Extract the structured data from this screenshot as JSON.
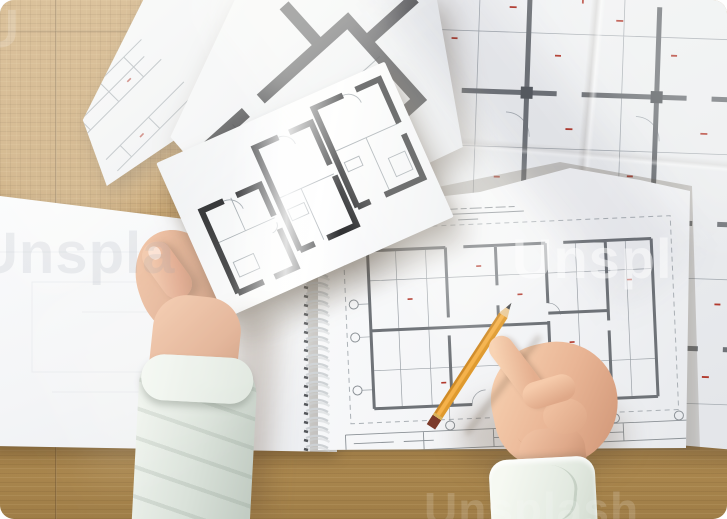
{
  "scene": {
    "description": "Overhead photo of an architect's wooden desk: several floor-plan drawings, a spiral-bound pad with a pencil-drawn apartment plan, a left hand holding a small plan sheet and a right hand writing with a yellow pencil."
  },
  "watermarks": {
    "center": "Unspl",
    "left_partial": "Unspla",
    "bottom": "Unsplash",
    "top_left_partial": "U"
  },
  "palette": {
    "wood_base": "#bf9963",
    "wood_light": "#d7b77f",
    "wood_seam": "#7d5f35",
    "paper_white": "#f7f8f9",
    "plan_wall_dark": "#2b2c2e",
    "plan_wall_gray": "#6e7277",
    "plan_line_gray": "#9aa2a8",
    "plan_line_faint": "#b9bfc5",
    "red_annotation": "#b23a2e",
    "column_fill": "#565a5f",
    "skin": "#e0a98c",
    "sleeve_left": "#dde4dd",
    "sleeve_right": "#eef2ed",
    "pencil_yellow": "#eda63a",
    "pencil_ferrule": "#7c3a2a",
    "graphite": "#434548",
    "spiral_wire": "#cdd1d4",
    "spiral_dark": "#53565a"
  },
  "drawings": {
    "held_walls": "M22 152 V62 H46 M60 62 H86 V96 M86 110 V152 H62 M50 152 H22 M96 138 V26 H122 M134 26 H158 V72 M158 84 V138 H126 M112 138 H96 M166 122 V14 H198 M212 14 H238 V62 M238 74 V122 H196 M180 122 H166",
    "held_thin": "M22 98 H86 M54 62 V98 M96 82 H158 M122 82 V138 M166 62 H238 M202 62 V122 M30 122 h22 v16 h-22 z M101 96 h18 v12 h-18 z M172 76 h16 v10 h-16 z M214 90 h18 v20 h-18 z",
    "held_doors": "M46 62 a15 15 0 0 1 15 15 M122 26 a13 13 0 0 1 13 13 M198 14 a14 14 0 0 1 14 14 M86 103 a8 8 0 0 1 -8 8",
    "dark_walls": "M10 72 H118 M138 72 H255 V128 M58 72 V178 M58 198 V250 M58 178 H168 M188 178 H255 V128 M218 72 V18 M255 100 H320",
    "dark_thin": "M100 72 V178 M58 120 H255 M150 120 V178",
    "dark_detail": "M70 90 h26 v14 h-26 z M200 140 h30 v16 h-30 z",
    "sketch_lines": "M10 20 H120 M10 34 H110 M10 48 H120 M20 20 V48 M60 20 V48 M95 20 V48 M10 80 H120 M10 96 H115 M30 80 V96 M70 80 V96 M10 120 H100 M10 134 H96 M40 120 V134",
    "sketch_red": "M30 28 h5 M80 40 h5 M50 88 h5 M85 126 h5",
    "detail_walls": "M5 130 H75 M100 130 H195 M220 130 H325 M350 130 H405 M55 130 V45 M165 130 V35 M295 130 V40 M385 130 V45 M5 255 H85 M110 255 H205 M230 255 H335 M360 255 H405 M55 255 V130 M165 255 V130 M295 255 V130 M385 255 V130 M5 380 H95 M120 380 H215 M240 380 H345 M370 380 H405 M75 380 V255 M185 380 V255 M315 380 V255 M395 380 V255",
    "detail_cols": "M49 124 h12 v12 h-12 z M159 124 h12 v12 h-12 z M289 124 h12 v12 h-12 z M379 124 h12 v12 h-12 z M49 249 h12 v12 h-12 z M159 249 h12 v12 h-12 z M289 249 h12 v12 h-12 z M379 249 h12 v12 h-12 z M69 374 h12 v12 h-12 z M179 374 h12 v12 h-12 z M309 374 h12 v12 h-12 z",
    "detail_thin": "M5 70 H405 M5 185 H405 M5 310 H405 M5 435 H405 M115 5 V465 M260 5 V465 M35 150 a24 24 0 0 1 24 24 M145 150 a24 24 0 0 1 24 24 M275 150 a24 24 0 0 1 24 24 M35 275 a24 24 0 0 1 24 24 M145 275 a24 24 0 0 1 24 24 M275 275 a24 24 0 0 1 24 24 M55 400 a24 24 0 0 1 24 24 M185 400 a24 24 0 0 1 24 24",
    "detail_red": "M30 50 h7 M88 78 h6 M145 45 h7 M192 92 h6 M252 55 h7 M308 88 h6 M365 50 h7 M22 155 h6 M78 182 h7 M135 215 h6 M205 165 h7 M268 210 h6 M340 165 h7 M390 205 h6 M38 285 h7 M98 330 h6 M160 295 h7 M232 340 h6 M298 290 h7 M360 335 h6 M48 408 h7 M125 430 h6 M208 408 h7 M288 435 h6 M350 408 h7 M392 365 h6 M62 22 v7 M218 32 v7 M332 18 v7 M378 275 v7 M258 385 v7 M92 248 v7",
    "ghost_lines": "M0 60 H180 M40 90 H200 V180 H40 Z M90 120 H170 M60 200 H240 V250",
    "nb_frame": "M28 58 H356 V252 H28 Z",
    "nb_walls": "M52 80 H130 M148 80 H230 M248 80 H336 M52 80 V238 M336 80 V238 M52 238 H150 M170 238 H336 M130 80 V150 M130 168 V238 M230 80 V140 M230 158 V238 M290 80 V160 M52 160 H130 M230 150 H290 M290 170 V238 M180 80 V120 M180 140 V160 M130 160 H230",
    "nb_thin": "M80 80 V238 M110 80 V238 M260 80 V238 M310 80 V238 M52 110 H336 M52 200 H336 M150 238 a14 14 0 0 1 14 -14 M230 140 a12 12 0 0 1 12 12 M40.5 133 H52 M40.5 166 H52 M40.5 219 H52 M127 253.5 V238 M227 253.5 V238 M292 253.5 V238",
    "nb_red": "M90 130 h5 M160 100 h5 M250 180 h5 M310 120 h5 M120 215 h5 M270 215 h5 M200 130 h5",
    "nb_circles": "M31.5 133 a4.5 4.5 0 1 0 9 0 a4.5 4.5 0 1 0 -9 0 M31.5 166 a4.5 4.5 0 1 0 9 0 a4.5 4.5 0 1 0 -9 0 M31.5 219 a4.5 4.5 0 1 0 9 0 a4.5 4.5 0 1 0 -9 0 M122.5 258 a4.5 4.5 0 1 0 9 0 a4.5 4.5 0 1 0 -9 0 M222.5 258 a4.5 4.5 0 1 0 9 0 a4.5 4.5 0 1 0 -9 0 M287.5 258 a4.5 4.5 0 1 0 9 0 a4.5 4.5 0 1 0 -9 0 M351.5 258 a4.5 4.5 0 1 0 9 0 a4.5 4.5 0 1 0 -9 0",
    "nb_title": "M92 42 h8 m3 0 h6 m3 0 h10 m3 0 h7 m3 0 h9 m3 0 h6 m3 0 h12 m3 0 h8 m3 0 h10 m3 0 h6 M92 47 H210 M144 53 h20",
    "nb_block": "M22 263 H368 M22 281 H368 M22 263 V281 M100 263 V281 M170 263 V281 M240 263 V281 M300 263 V281 M170 272 H300 M368 263 V281 M30 272 h40 m10 0 h30",
    "spiral_loops": "M4 4 q12 -5 22 1 M4 13 q12 -5 22 1 M4 22 q12 -5 22 1 M4 31 q12 -5 22 1 M4 40 q12 -5 22 1 M4 49 q12 -5 22 1 M4 58 q12 -5 22 1 M4 67 q12 -5 22 1 M4 76 q12 -5 22 1 M4 85 q12 -5 22 1 M4 94 q12 -5 22 1 M4 103 q12 -5 22 1 M4 112 q12 -5 22 1 M4 121 q12 -5 22 1 M4 130 q12 -5 22 1 M4 139 q12 -5 22 1 M4 148 q12 -5 22 1 M4 157 q12 -5 22 1 M4 166 q12 -5 22 1 M4 175 q12 -5 22 1",
    "spiral_dots": "M2 6 l4 1 M2 15 l4 1 M2 24 l4 1 M2 33 l4 1 M2 42 l4 1 M2 51 l4 1 M2 60 l4 1 M2 69 l4 1 M2 78 l4 1 M2 87 l4 1 M2 96 l4 1 M2 105 l4 1 M2 114 l4 1 M2 123 l4 1 M2 132 l4 1 M2 141 l4 1 M2 150 l4 1 M2 159 l4 1 M2 168 l4 1 M2 177 l4 1"
  }
}
